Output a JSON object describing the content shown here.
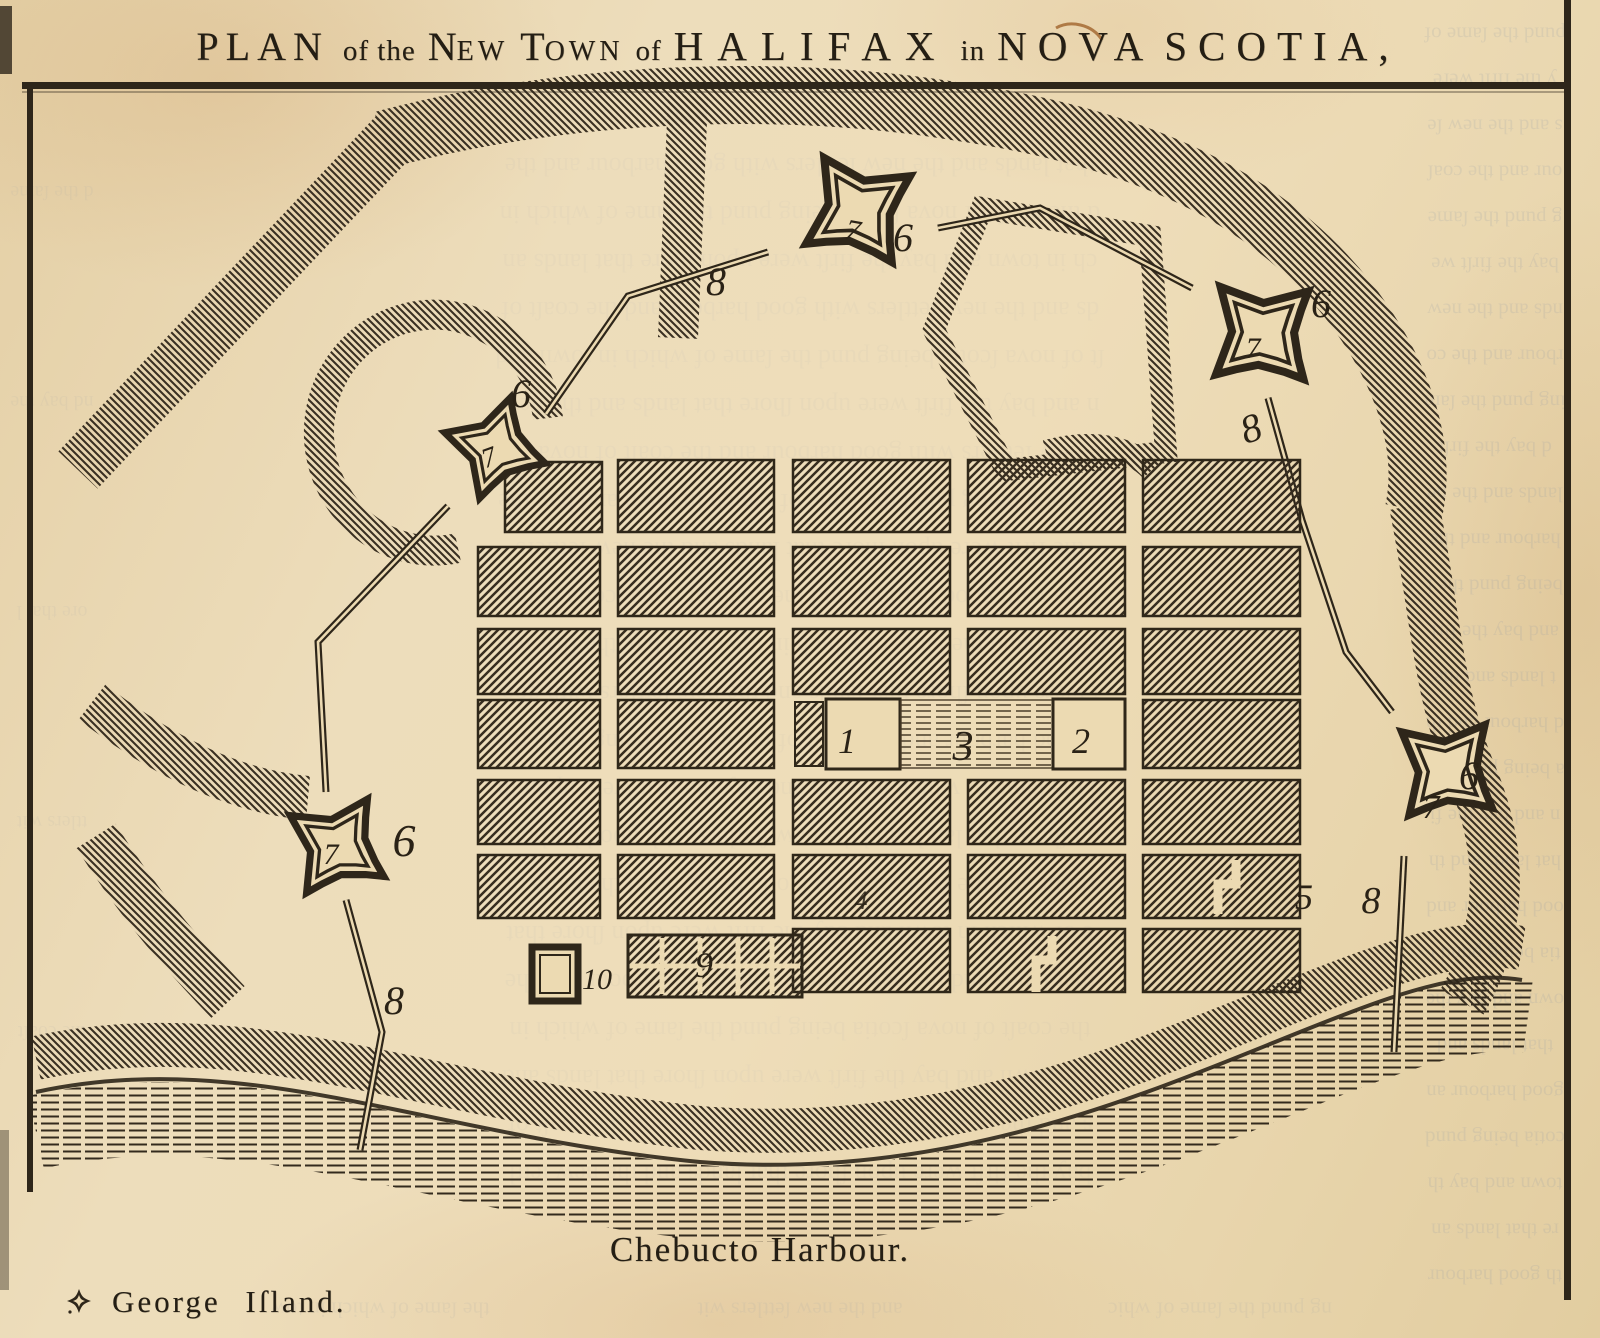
{
  "page": {
    "title_segments": [
      {
        "t": "PLAN",
        "fs": 40,
        "ls": 7,
        "gap": 14
      },
      {
        "t": "of the",
        "fs": 29,
        "ls": 1,
        "gap": 12
      },
      {
        "t": "N",
        "fs": 40,
        "ls": 0,
        "gap": 0
      },
      {
        "t": "EW",
        "fs": 28,
        "ls": 4,
        "gap": 12
      },
      {
        "t": "T",
        "fs": 40,
        "ls": 0,
        "gap": 0
      },
      {
        "t": "OWN",
        "fs": 28,
        "ls": 4,
        "gap": 12
      },
      {
        "t": "of",
        "fs": 29,
        "ls": 1,
        "gap": 12
      },
      {
        "t": "HALIFAX",
        "fs": 41,
        "ls": 14,
        "gap": 12
      },
      {
        "t": "in",
        "fs": 29,
        "ls": 1,
        "gap": 12
      },
      {
        "t": "NOVA",
        "fs": 41,
        "ls": 11,
        "gap": 10
      },
      {
        "t": "SCOTIA,",
        "fs": 41,
        "ls": 11,
        "gap": 0
      }
    ],
    "harbour_label": "Chebucto Harbour.",
    "island_label": "George Iſland.",
    "numbers": {
      "n1": "1",
      "n2": "2",
      "n3": "3",
      "n4": "4",
      "n5": "5",
      "n6": "6",
      "n7": "7",
      "n8": "8",
      "n9": "9",
      "n10": "10"
    },
    "colors": {
      "paper": "#ecdab2",
      "ink": "#2e261a",
      "ghost": "#8d97a6"
    },
    "ghost_text": "pund the ſame of which in town and bay the firſt were upon ſhore that lands and the new ſettlers with good harbour and the coaſt of nova ſcotia being"
  }
}
